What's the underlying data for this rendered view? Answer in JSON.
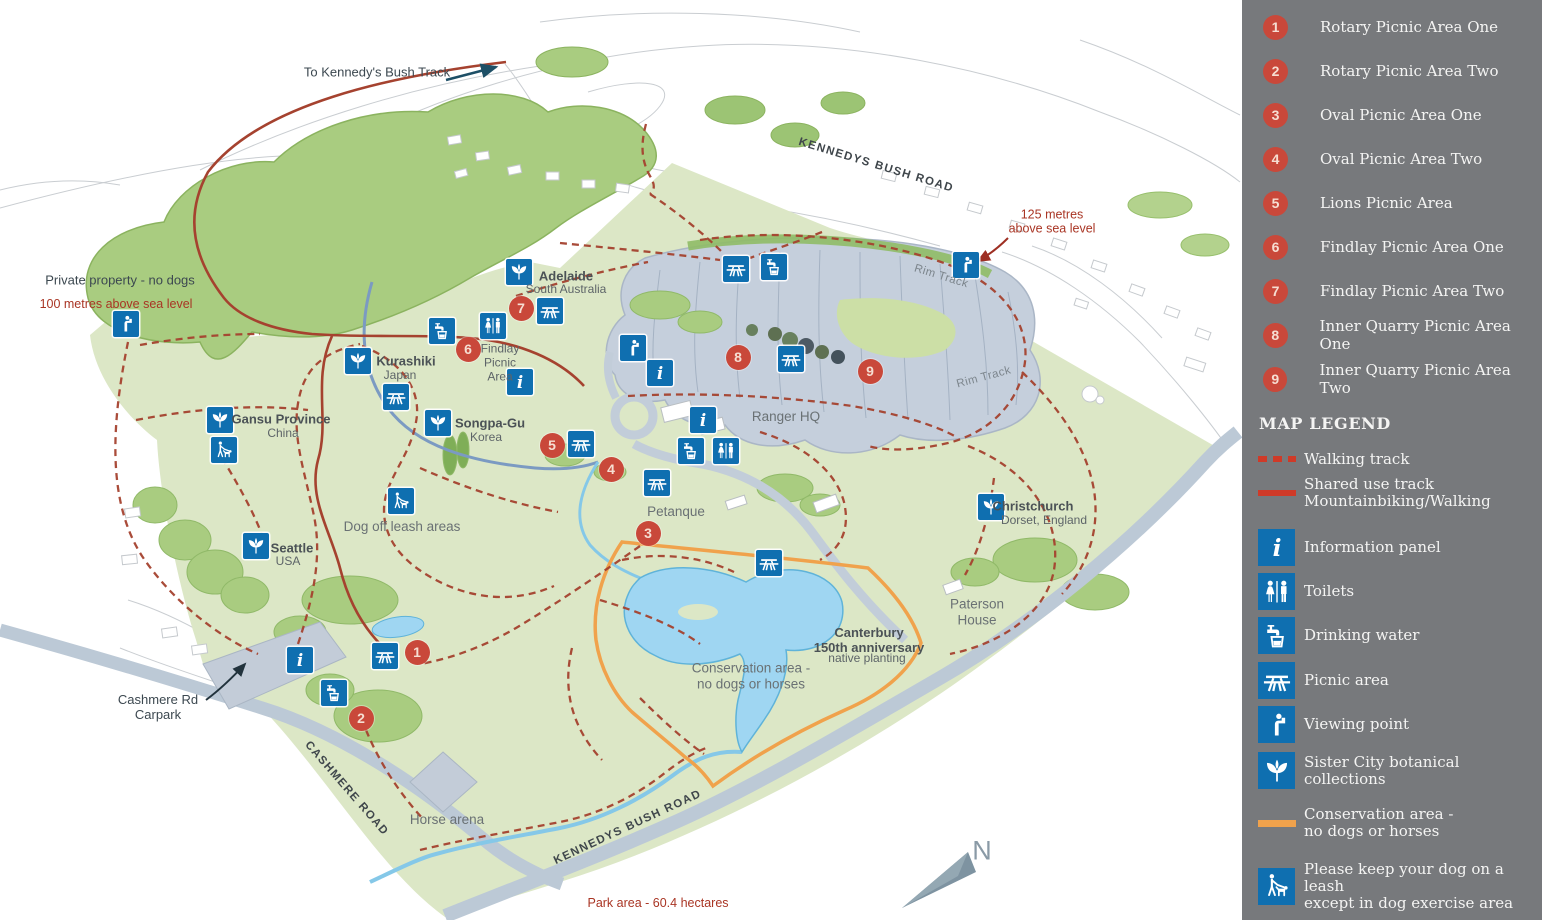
{
  "colors": {
    "sidebar_bg": "#77797c",
    "icon_blue": "#0f6fb0",
    "marker_red": "#c9483a",
    "track_red": "#a5422f",
    "legend_track_red": "#cf3a28",
    "conservation_orange": "#f0a24c",
    "park_green": "#dce7c6",
    "forest_green": "#a9cc80",
    "quarry_gray": "#c5cfdc",
    "road_gray": "#bcc9d6",
    "water_blue": "#9fd6f2"
  },
  "sidebar": {
    "numbered_areas": [
      {
        "num": "1",
        "label": "Rotary Picnic Area One"
      },
      {
        "num": "2",
        "label": "Rotary Picnic Area Two"
      },
      {
        "num": "3",
        "label": "Oval Picnic Area One"
      },
      {
        "num": "4",
        "label": "Oval Picnic Area Two"
      },
      {
        "num": "5",
        "label": "Lions Picnic Area"
      },
      {
        "num": "6",
        "label": "Findlay Picnic Area One"
      },
      {
        "num": "7",
        "label": "Findlay Picnic Area Two"
      },
      {
        "num": "8",
        "label": "Inner Quarry Picnic Area One"
      },
      {
        "num": "9",
        "label": "Inner Quarry Picnic Area Two"
      }
    ],
    "legend_title": "MAP LEGEND",
    "legend": [
      {
        "icon": "walking-track",
        "label": "Walking track"
      },
      {
        "icon": "shared-track",
        "label": "Shared use track\nMountainbiking/Walking"
      },
      {
        "icon": "info",
        "label": "Information panel"
      },
      {
        "icon": "toilets",
        "label": "Toilets"
      },
      {
        "icon": "water",
        "label": "Drinking water"
      },
      {
        "icon": "picnic",
        "label": "Picnic area"
      },
      {
        "icon": "viewpoint",
        "label": "Viewing point"
      },
      {
        "icon": "botanic",
        "label": "Sister City botanical\ncollections"
      },
      {
        "icon": "conservation",
        "label": "Conservation area -\nno dogs or horses"
      },
      {
        "icon": "dog-leash",
        "label": "Please keep your dog on a leash\nexcept in dog exercise area"
      }
    ]
  },
  "map": {
    "compass_label": "N",
    "labels": [
      {
        "text": "To Kennedy's Bush Track",
        "x": 377,
        "y": 73,
        "cls": "dark"
      },
      {
        "text": "KENNEDYS BUSH ROAD",
        "x": 876,
        "y": 166,
        "cls": "road",
        "rot": 17
      },
      {
        "text": "125 metres\nabove sea level",
        "x": 1052,
        "y": 222,
        "cls": "red"
      },
      {
        "text": "Private property - no dogs",
        "x": 120,
        "y": 281,
        "cls": "dark"
      },
      {
        "text": "100 metres above sea level",
        "x": 116,
        "y": 304,
        "cls": "red"
      },
      {
        "text": "Adelaide",
        "x": 566,
        "y": 277,
        "cls": "bold"
      },
      {
        "text": "South Australia",
        "x": 566,
        "y": 290,
        "cls": "sub"
      },
      {
        "text": "Findlay\nPicnic\nArea",
        "x": 500,
        "y": 363,
        "cls": "sub"
      },
      {
        "text": "Kurashiki",
        "x": 406,
        "y": 362,
        "cls": "bold"
      },
      {
        "text": "Japan",
        "x": 400,
        "y": 376,
        "cls": "sub"
      },
      {
        "text": "Songpa-Gu",
        "x": 490,
        "y": 424,
        "cls": "bold"
      },
      {
        "text": "Korea",
        "x": 486,
        "y": 438,
        "cls": "sub"
      },
      {
        "text": "Gansu Province",
        "x": 281,
        "y": 420,
        "cls": "bold"
      },
      {
        "text": "China",
        "x": 283,
        "y": 434,
        "cls": "sub"
      },
      {
        "text": "Seattle",
        "x": 292,
        "y": 549,
        "cls": "bold"
      },
      {
        "text": "USA",
        "x": 288,
        "y": 562,
        "cls": "sub"
      },
      {
        "text": "Dog off leash areas",
        "x": 402,
        "y": 527,
        "cls": "plain"
      },
      {
        "text": "Rim Track",
        "x": 941,
        "y": 277,
        "cls": "track",
        "rot": 17
      },
      {
        "text": "Rim Track",
        "x": 984,
        "y": 378,
        "cls": "track",
        "rot": -15
      },
      {
        "text": "Ranger HQ",
        "x": 786,
        "y": 417,
        "cls": "plain"
      },
      {
        "text": "Petanque",
        "x": 676,
        "y": 512,
        "cls": "plain"
      },
      {
        "text": "Christchurch",
        "x": 1033,
        "y": 507,
        "cls": "bold"
      },
      {
        "text": "Dorset, England",
        "x": 1044,
        "y": 521,
        "cls": "sub"
      },
      {
        "text": "Paterson\nHouse",
        "x": 977,
        "y": 612,
        "cls": "plain"
      },
      {
        "text": "Canterbury\n150th anniversary",
        "x": 869,
        "y": 641,
        "cls": "bold"
      },
      {
        "text": "native planting",
        "x": 867,
        "y": 659,
        "cls": "sub"
      },
      {
        "text": "Conservation area -\nno dogs or horses",
        "x": 751,
        "y": 676,
        "cls": "plain"
      },
      {
        "text": "Cashmere Rd\nCarpark",
        "x": 158,
        "y": 708,
        "cls": "dark"
      },
      {
        "text": "CASHMERE ROAD",
        "x": 346,
        "y": 789,
        "cls": "road",
        "rot": 49
      },
      {
        "text": "Horse arena",
        "x": 447,
        "y": 820,
        "cls": "plain"
      },
      {
        "text": "KENNEDYS BUSH ROAD",
        "x": 628,
        "y": 828,
        "cls": "road",
        "rot": -25
      },
      {
        "text": "Park area - 60.4 hectares",
        "x": 658,
        "y": 903,
        "cls": "red"
      }
    ],
    "markers": [
      {
        "type": "viewpoint",
        "x": 126,
        "y": 324
      },
      {
        "type": "botanic",
        "x": 519,
        "y": 272
      },
      {
        "type": "picnic",
        "x": 550,
        "y": 311
      },
      {
        "type": "toilets",
        "x": 493,
        "y": 326
      },
      {
        "type": "water",
        "x": 442,
        "y": 331
      },
      {
        "type": "info",
        "x": 520,
        "y": 382
      },
      {
        "type": "botanic",
        "x": 358,
        "y": 361
      },
      {
        "type": "picnic",
        "x": 396,
        "y": 397
      },
      {
        "type": "botanic",
        "x": 438,
        "y": 423
      },
      {
        "type": "botanic",
        "x": 220,
        "y": 420
      },
      {
        "type": "dogwalk",
        "x": 224,
        "y": 450
      },
      {
        "type": "dogwalk",
        "x": 401,
        "y": 501
      },
      {
        "type": "botanic",
        "x": 256,
        "y": 546
      },
      {
        "type": "picnic",
        "x": 581,
        "y": 444
      },
      {
        "type": "picnic",
        "x": 736,
        "y": 269
      },
      {
        "type": "water",
        "x": 774,
        "y": 267
      },
      {
        "type": "viewpoint",
        "x": 966,
        "y": 265
      },
      {
        "type": "viewpoint",
        "x": 633,
        "y": 348
      },
      {
        "type": "info",
        "x": 660,
        "y": 373
      },
      {
        "type": "picnic",
        "x": 791,
        "y": 359
      },
      {
        "type": "info",
        "x": 703,
        "y": 420
      },
      {
        "type": "water",
        "x": 691,
        "y": 451
      },
      {
        "type": "toilets",
        "x": 726,
        "y": 451
      },
      {
        "type": "picnic",
        "x": 657,
        "y": 483
      },
      {
        "type": "picnic",
        "x": 769,
        "y": 563
      },
      {
        "type": "info",
        "x": 300,
        "y": 660
      },
      {
        "type": "picnic",
        "x": 385,
        "y": 656
      },
      {
        "type": "water",
        "x": 334,
        "y": 693
      },
      {
        "type": "botanic",
        "x": 991,
        "y": 507
      }
    ],
    "area_markers": [
      {
        "num": "1",
        "x": 417,
        "y": 652
      },
      {
        "num": "2",
        "x": 361,
        "y": 718
      },
      {
        "num": "3",
        "x": 648,
        "y": 533
      },
      {
        "num": "4",
        "x": 611,
        "y": 469
      },
      {
        "num": "5",
        "x": 552,
        "y": 445
      },
      {
        "num": "6",
        "x": 468,
        "y": 349
      },
      {
        "num": "7",
        "x": 521,
        "y": 308
      },
      {
        "num": "8",
        "x": 738,
        "y": 357
      },
      {
        "num": "9",
        "x": 870,
        "y": 371
      }
    ]
  }
}
